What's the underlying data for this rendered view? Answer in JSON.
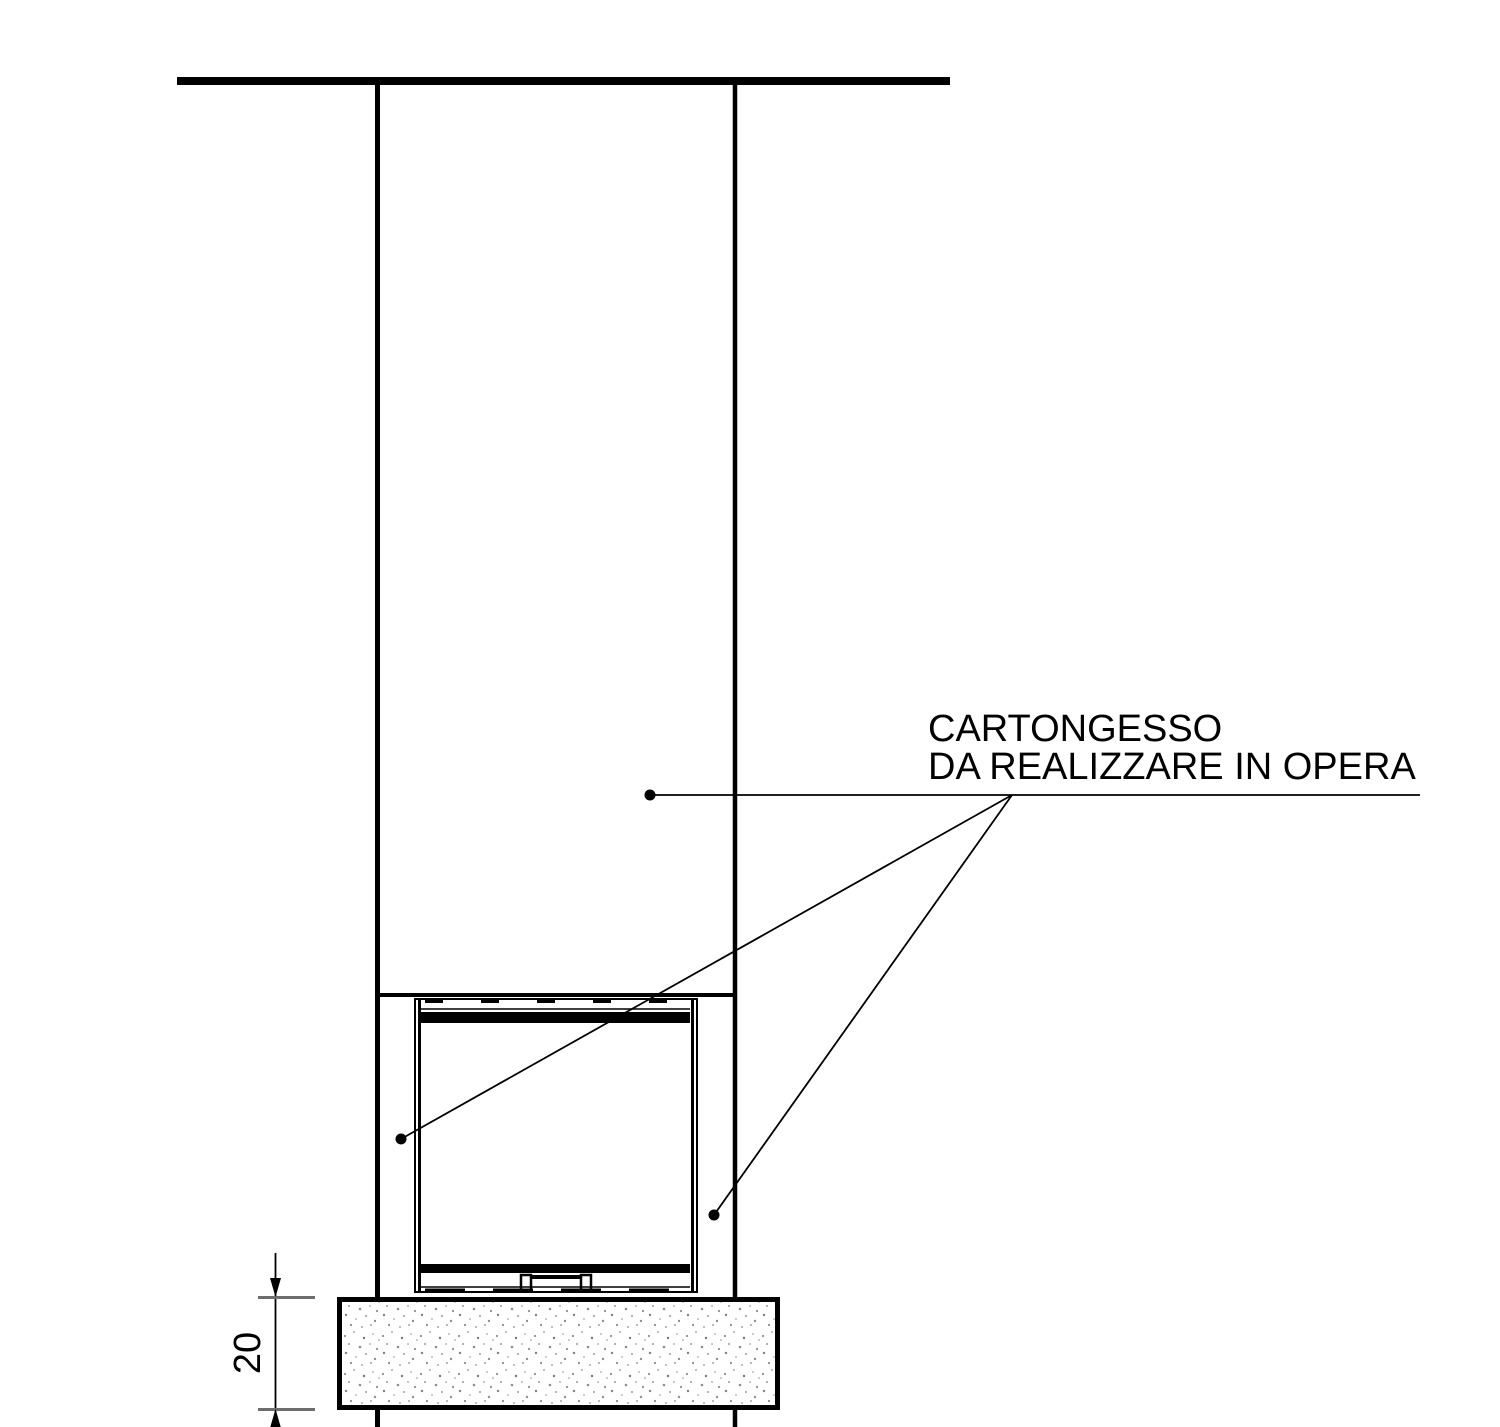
{
  "page": {
    "width": 1500,
    "height": 1427,
    "background": "#ffffff"
  },
  "annotation": {
    "line1": "CARTONGESSO",
    "line2": "DA REALIZZARE IN OPERA"
  },
  "dimension": {
    "value": "20"
  },
  "colors": {
    "line": "#000000",
    "tick": "#6e6e6e",
    "stipple": "#8f8f8f",
    "background": "#ffffff"
  }
}
